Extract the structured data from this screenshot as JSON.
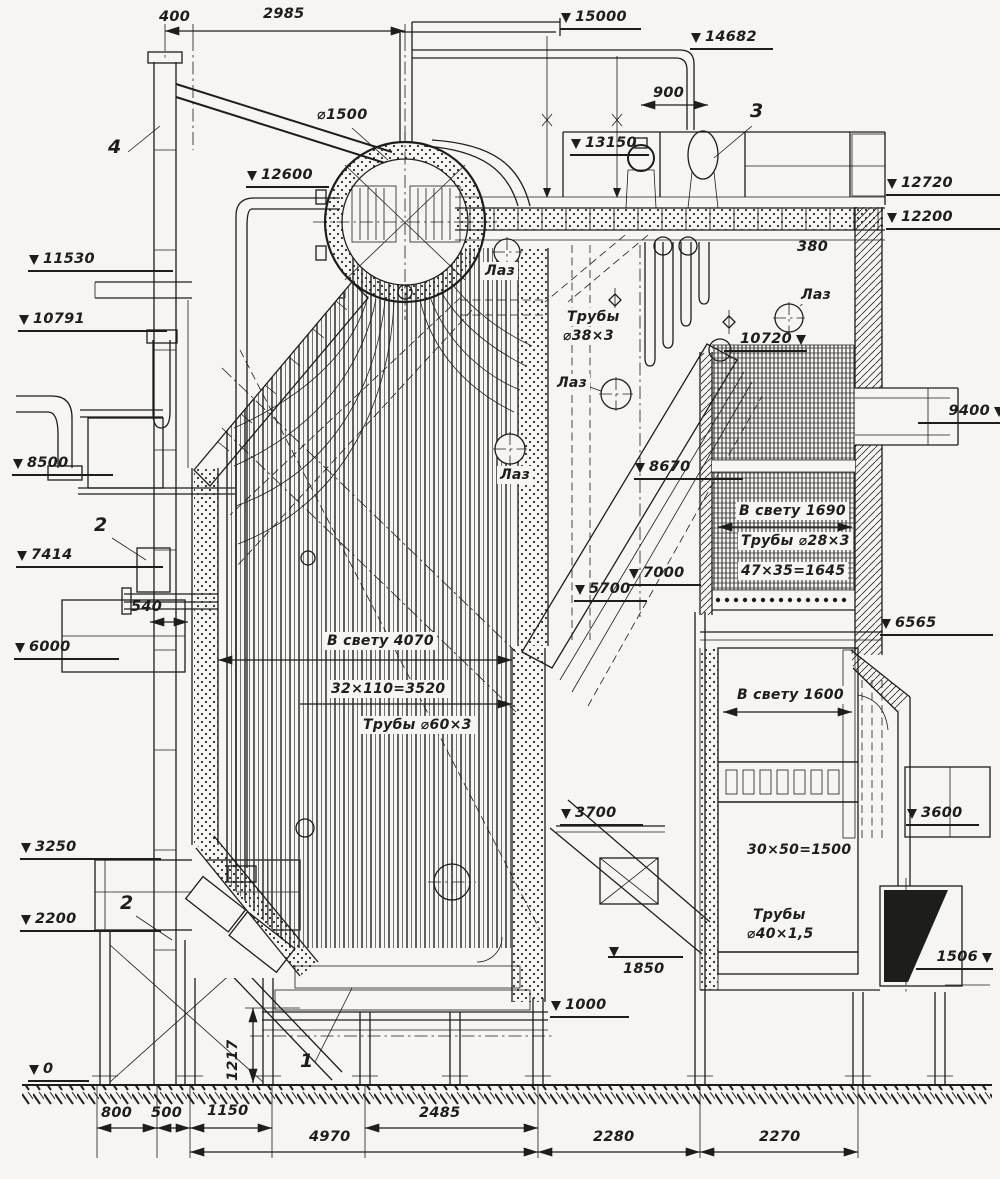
{
  "drawing": {
    "type": "boiler-longitudinal-section",
    "paper_color": "#f6f5f1",
    "ink_color": "#1d1d1b"
  },
  "annotations": [
    {
      "name": "elevation-15000",
      "cls": "elev",
      "text": "15000",
      "x": 560,
      "y": 8,
      "w": 64
    },
    {
      "name": "elevation-14682",
      "cls": "elev",
      "text": "14682",
      "x": 690,
      "y": 28,
      "w": 66
    },
    {
      "name": "elevation-13150",
      "cls": "elev",
      "text": "13150",
      "x": 570,
      "y": 134,
      "w": 62
    },
    {
      "name": "elevation-12720",
      "cls": "elev",
      "text": "12720",
      "x": 886,
      "y": 174,
      "w": 104
    },
    {
      "name": "elevation-12200",
      "cls": "elev",
      "text": "12200",
      "x": 886,
      "y": 208,
      "w": 104
    },
    {
      "name": "elevation-12600",
      "cls": "elev",
      "text": "12600",
      "x": 246,
      "y": 166,
      "w": 66
    },
    {
      "name": "elevation-11530",
      "cls": "elev",
      "text": "11530",
      "x": 28,
      "y": 250,
      "w": 128
    },
    {
      "name": "elevation-10791",
      "cls": "elev",
      "text": "10791",
      "x": 18,
      "y": 310,
      "w": 132
    },
    {
      "name": "elevation-10720",
      "cls": "elev right",
      "text": "10720",
      "x": 724,
      "y": 330,
      "w": 66
    },
    {
      "name": "elevation-9400",
      "cls": "elev right",
      "text": "9400",
      "x": 918,
      "y": 402,
      "w": 70
    },
    {
      "name": "elevation-8670",
      "cls": "elev",
      "text": "8670",
      "x": 634,
      "y": 458,
      "w": 92
    },
    {
      "name": "elevation-8500",
      "cls": "elev",
      "text": "8500",
      "x": 12,
      "y": 454,
      "w": 84
    },
    {
      "name": "elevation-7414",
      "cls": "elev",
      "text": "7414",
      "x": 16,
      "y": 546,
      "w": 130
    },
    {
      "name": "elevation-7000",
      "cls": "elev",
      "text": "7000",
      "x": 628,
      "y": 564,
      "w": 56
    },
    {
      "name": "elevation-6565",
      "cls": "elev",
      "text": "6565",
      "x": 880,
      "y": 614,
      "w": 96
    },
    {
      "name": "elevation-6000",
      "cls": "elev",
      "text": "6000",
      "x": 14,
      "y": 638,
      "w": 88
    },
    {
      "name": "elevation-5700",
      "cls": "elev",
      "text": "5700",
      "x": 574,
      "y": 580,
      "w": 56
    },
    {
      "name": "elevation-3700",
      "cls": "elev",
      "text": "3700",
      "x": 560,
      "y": 804,
      "w": 66
    },
    {
      "name": "elevation-3600",
      "cls": "elev",
      "text": "3600",
      "x": 906,
      "y": 804,
      "w": 56
    },
    {
      "name": "elevation-3250",
      "cls": "elev",
      "text": "3250",
      "x": 20,
      "y": 838,
      "w": 124
    },
    {
      "name": "elevation-2200",
      "cls": "elev",
      "text": "2200",
      "x": 20,
      "y": 910,
      "w": 124
    },
    {
      "name": "elevation-1850",
      "cls": "elev top",
      "text": "1850",
      "x": 608,
      "y": 956,
      "w": 58
    },
    {
      "name": "elevation-1506",
      "cls": "elev right",
      "text": "1506",
      "x": 916,
      "y": 948,
      "w": 60
    },
    {
      "name": "elevation-1000",
      "cls": "elev",
      "text": "1000",
      "x": 550,
      "y": 996,
      "w": 62
    },
    {
      "name": "elevation-0",
      "cls": "elev",
      "text": "0",
      "x": 28,
      "y": 1060,
      "w": 44
    },
    {
      "name": "dim-400",
      "cls": "dim",
      "text": "400",
      "x": 158,
      "y": 8
    },
    {
      "name": "dim-2985",
      "cls": "dim",
      "text": "2985",
      "x": 262,
      "y": 5
    },
    {
      "name": "dim-900",
      "cls": "dim",
      "text": "900",
      "x": 652,
      "y": 84
    },
    {
      "name": "dim-380",
      "cls": "dim",
      "text": "380",
      "x": 796,
      "y": 238
    },
    {
      "name": "dim-540",
      "cls": "dim",
      "text": "540",
      "x": 130,
      "y": 598
    },
    {
      "name": "dim-800",
      "cls": "dim",
      "text": "800",
      "x": 100,
      "y": 1104
    },
    {
      "name": "dim-500",
      "cls": "dim",
      "text": "500",
      "x": 150,
      "y": 1104
    },
    {
      "name": "dim-1150",
      "cls": "dim",
      "text": "1150",
      "x": 206,
      "y": 1102
    },
    {
      "name": "dim-2485",
      "cls": "dim",
      "text": "2485",
      "x": 418,
      "y": 1104
    },
    {
      "name": "dim-4970",
      "cls": "dim",
      "text": "4970",
      "x": 308,
      "y": 1128
    },
    {
      "name": "dim-2280",
      "cls": "dim",
      "text": "2280",
      "x": 592,
      "y": 1128
    },
    {
      "name": "dim-2270",
      "cls": "dim",
      "text": "2270",
      "x": 758,
      "y": 1128
    },
    {
      "name": "dim-1217",
      "cls": "dim",
      "text": "1217",
      "x": 224,
      "y": 1082,
      "rot": -90
    },
    {
      "name": "dim-drum-diameter",
      "cls": "dim",
      "text": "⌀1500",
      "x": 316,
      "y": 106
    },
    {
      "name": "note-tubes-38-line1",
      "cls": "note",
      "text": "Трубы",
      "x": 564,
      "y": 308
    },
    {
      "name": "note-tubes-38-line2",
      "cls": "note",
      "text": "⌀38×3",
      "x": 560,
      "y": 327
    },
    {
      "name": "note-clear-width-4070",
      "cls": "note",
      "text": "В свету 4070",
      "x": 324,
      "y": 632
    },
    {
      "name": "note-pitch-32x110",
      "cls": "note",
      "text": "32×110=3520",
      "x": 328,
      "y": 680
    },
    {
      "name": "note-tubes-60",
      "cls": "note",
      "text": "Трубы ⌀60×3",
      "x": 360,
      "y": 716
    },
    {
      "name": "note-clear-width-1690",
      "cls": "note",
      "text": "В свету 1690",
      "x": 736,
      "y": 502
    },
    {
      "name": "note-tubes-28",
      "cls": "note",
      "text": "Трубы ⌀28×3",
      "x": 738,
      "y": 532
    },
    {
      "name": "note-pitch-47x35",
      "cls": "note",
      "text": "47×35=1645",
      "x": 738,
      "y": 562
    },
    {
      "name": "note-clear-width-1600",
      "cls": "note",
      "text": "В свету 1600",
      "x": 734,
      "y": 686
    },
    {
      "name": "note-pitch-30x50",
      "cls": "note",
      "text": "30×50=1500",
      "x": 744,
      "y": 841
    },
    {
      "name": "note-tubes-40-line1",
      "cls": "note",
      "text": "Трубы",
      "x": 750,
      "y": 906
    },
    {
      "name": "note-tubes-40-line2",
      "cls": "note",
      "text": "⌀40×1,5",
      "x": 744,
      "y": 925
    },
    {
      "name": "manhole-label-1",
      "cls": "note",
      "text": "Лаз",
      "x": 482,
      "y": 262
    },
    {
      "name": "manhole-label-2",
      "cls": "note",
      "text": "Лаз",
      "x": 554,
      "y": 374
    },
    {
      "name": "manhole-label-3",
      "cls": "note",
      "text": "Лаз",
      "x": 497,
      "y": 466
    },
    {
      "name": "manhole-label-4",
      "cls": "note",
      "text": "Лаз",
      "x": 798,
      "y": 286
    },
    {
      "name": "part-number-4",
      "cls": "part",
      "text": "4",
      "x": 108,
      "y": 138
    },
    {
      "name": "part-number-2-upper",
      "cls": "part",
      "text": "2",
      "x": 94,
      "y": 516
    },
    {
      "name": "part-number-2-lower",
      "cls": "part",
      "text": "2",
      "x": 120,
      "y": 894
    },
    {
      "name": "part-number-3",
      "cls": "part",
      "text": "3",
      "x": 750,
      "y": 102
    },
    {
      "name": "part-number-1",
      "cls": "part",
      "text": "1",
      "x": 300,
      "y": 1052
    }
  ]
}
